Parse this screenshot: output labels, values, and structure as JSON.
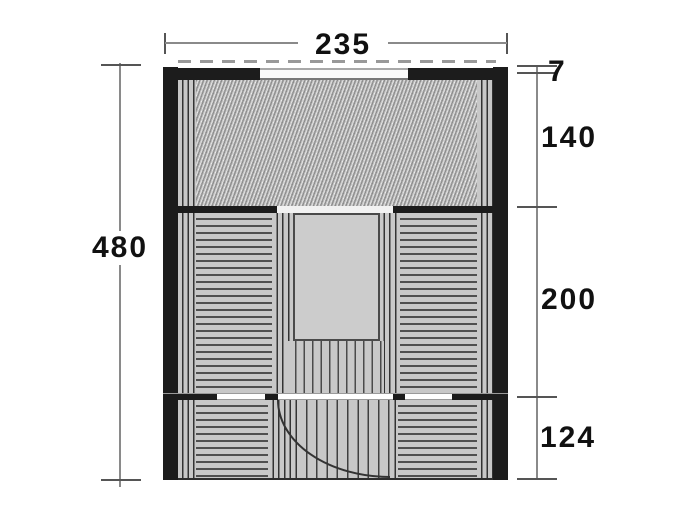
{
  "diagram": {
    "type": "floor-plan dimension drawing",
    "overall": {
      "width_label": "235",
      "depth_label": "480"
    },
    "right_dimensions": [
      {
        "label": "7"
      },
      {
        "label": "140"
      },
      {
        "label": "200"
      },
      {
        "label": "124"
      }
    ],
    "colors": {
      "wall": "#1c1c1c",
      "panel": "#c8c8c8",
      "hatch_base": "#b5b5b5",
      "dimension_line": "#8a8a8a",
      "background": "#ffffff"
    }
  }
}
